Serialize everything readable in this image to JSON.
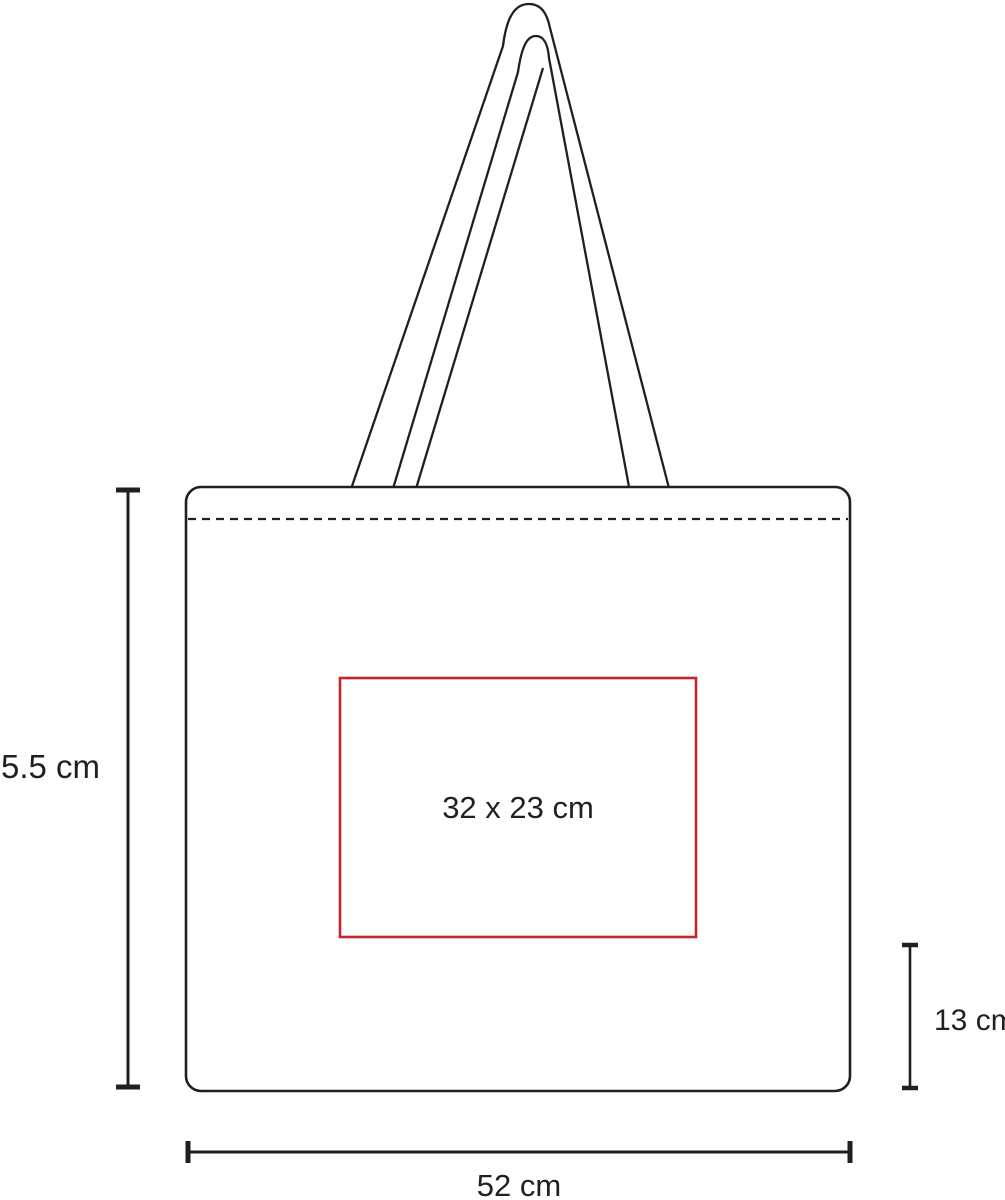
{
  "diagram": {
    "labels": {
      "height": "35.5 cm",
      "width": "52 cm",
      "side": "13 cm",
      "print_area": "32 x 23 cm"
    },
    "colors": {
      "line": "#231f20",
      "print_area": "#c1272d"
    }
  }
}
